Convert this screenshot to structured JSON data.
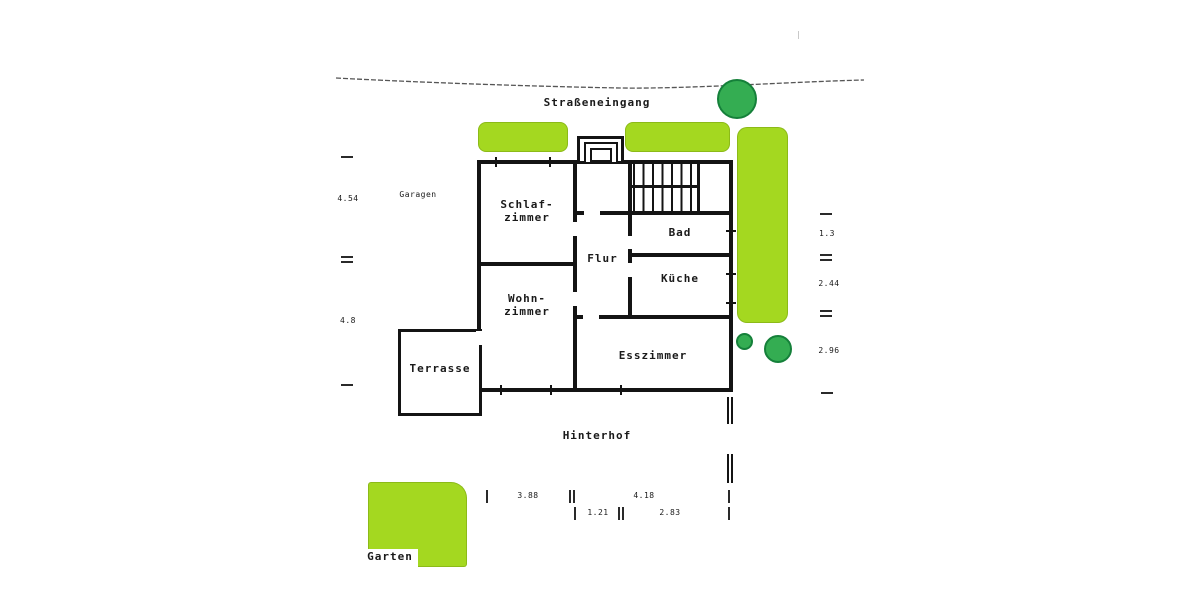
{
  "plan": {
    "street_label": "Straßeneingang",
    "garages_label": "Garagen",
    "backyard_label": "Hinterhof",
    "garden_label": "Garten",
    "rooms": {
      "schlafzimmer": {
        "line1": "Schlaf-",
        "line2": "zimmer"
      },
      "wohnzimmer": {
        "line1": "Wohn-",
        "line2": "zimmer"
      },
      "flur": {
        "label": "Flur"
      },
      "bad": {
        "label": "Bad"
      },
      "kueche": {
        "label": "Küche"
      },
      "esszimmer": {
        "label": "Esszimmer"
      },
      "terrasse": {
        "label": "Terrasse"
      }
    },
    "dimensions": {
      "left_top": "4.54",
      "left_bottom": "4.8",
      "right_top": "1.3",
      "right_middle": "2.44",
      "right_bottom": "2.96",
      "bottom_row1_left": "3.88",
      "bottom_row1_right": "4.18",
      "bottom_row2_left": "1.21",
      "bottom_row2_right": "2.83"
    },
    "colors": {
      "hedge": "#a4d820",
      "tree": "#34ad52",
      "wall": "#141414"
    }
  }
}
